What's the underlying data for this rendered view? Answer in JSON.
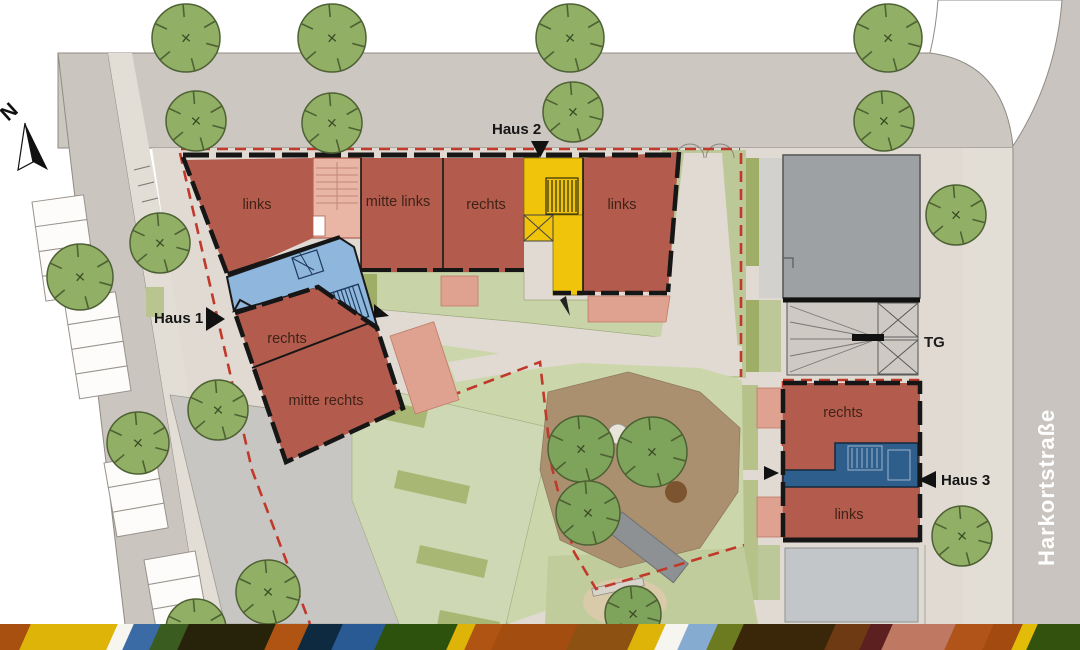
{
  "labels": {
    "north": "N",
    "street": "Harkortstraße",
    "garage": "TG"
  },
  "houses": [
    {
      "name": "Haus 1",
      "tx": 154,
      "ty": 323,
      "triangle": "206,307 206,331 225,319"
    },
    {
      "name": "Haus 2",
      "tx": 492,
      "ty": 134,
      "triangle": "531,141 549,141 540,158"
    },
    {
      "name": "Haus 3",
      "tx": 941,
      "ty": 485,
      "triangle": "936,471 936,488 918,480"
    }
  ],
  "units": [
    {
      "label": "links",
      "x": 257,
      "y": 209
    },
    {
      "label": "mitte links",
      "x": 398,
      "y": 206
    },
    {
      "label": "rechts",
      "x": 486,
      "y": 209
    },
    {
      "label": "links",
      "x": 622,
      "y": 209
    },
    {
      "label": "rechts",
      "x": 287,
      "y": 343
    },
    {
      "label": "mitte rechts",
      "x": 326,
      "y": 405
    },
    {
      "label": "rechts",
      "x": 843,
      "y": 417
    },
    {
      "label": "links",
      "x": 849,
      "y": 519
    }
  ],
  "trees": {
    "street": [
      [
        186,
        38,
        34
      ],
      [
        332,
        38,
        34
      ],
      [
        570,
        38,
        34
      ],
      [
        888,
        38,
        34
      ],
      [
        196,
        121,
        30
      ],
      [
        332,
        123,
        30
      ],
      [
        573,
        112,
        30
      ],
      [
        884,
        121,
        30
      ],
      [
        956,
        215,
        30
      ],
      [
        962,
        536,
        30
      ],
      [
        80,
        277,
        33
      ],
      [
        160,
        243,
        30
      ],
      [
        138,
        443,
        31
      ],
      [
        218,
        410,
        30
      ],
      [
        196,
        629,
        30
      ],
      [
        268,
        592,
        32
      ]
    ],
    "courtyard": [
      [
        581,
        449,
        33
      ],
      [
        652,
        452,
        35
      ],
      [
        588,
        513,
        32
      ],
      [
        633,
        614,
        28
      ]
    ]
  },
  "stripes": [
    {
      "x": 0,
      "w": 25,
      "c": "#a8500f"
    },
    {
      "x": 25,
      "w": 87,
      "c": "#dfb408"
    },
    {
      "x": 112,
      "w": 16,
      "c": "#f7f5f0"
    },
    {
      "x": 128,
      "w": 27,
      "c": "#3a6ba5"
    },
    {
      "x": 155,
      "w": 28,
      "c": "#3b5c20"
    },
    {
      "x": 183,
      "w": 87,
      "c": "#27220a"
    },
    {
      "x": 270,
      "w": 33,
      "c": "#b05413"
    },
    {
      "x": 303,
      "w": 34,
      "c": "#0e2a40"
    },
    {
      "x": 337,
      "w": 43,
      "c": "#2a5a94"
    },
    {
      "x": 380,
      "w": 72,
      "c": "#2c520e"
    },
    {
      "x": 452,
      "w": 18,
      "c": "#dfb408"
    },
    {
      "x": 470,
      "w": 27,
      "c": "#b05413"
    },
    {
      "x": 497,
      "w": 75,
      "c": "#a34d10"
    },
    {
      "x": 572,
      "w": 61,
      "c": "#8d5212"
    },
    {
      "x": 633,
      "w": 27,
      "c": "#dfb408"
    },
    {
      "x": 660,
      "w": 23,
      "c": "#f7f5f0"
    },
    {
      "x": 683,
      "w": 29,
      "c": "#85abd0"
    },
    {
      "x": 712,
      "w": 26,
      "c": "#6c7a20"
    },
    {
      "x": 738,
      "w": 92,
      "c": "#3a2608"
    },
    {
      "x": 830,
      "w": 35,
      "c": "#6e3a14"
    },
    {
      "x": 865,
      "w": 22,
      "c": "#5c2020"
    },
    {
      "x": 887,
      "w": 63,
      "c": "#bf7862"
    },
    {
      "x": 950,
      "w": 38,
      "c": "#b0541a"
    },
    {
      "x": 988,
      "w": 29,
      "c": "#a34a10"
    },
    {
      "x": 1017,
      "w": 15,
      "c": "#e2bc08"
    },
    {
      "x": 1032,
      "w": 48,
      "c": "#32520e"
    }
  ],
  "colors": {
    "building": "#b35b4d",
    "terrace": "#dfa190",
    "stair-salmon": "#e9b5a5",
    "stair-yellow": "#f0c40a",
    "stair-blue": "#8fb6dc",
    "stair-darkblue": "#2e5e8c",
    "existing-gray": "#9da1a3",
    "street": "#cdc7c2",
    "sidewalk": "#e2ddd5",
    "ground": "#e0dad2",
    "plaza": "#c7c6c2",
    "lawn": "#c9d3a8",
    "lawn2": "#bcc897",
    "hedge": "#9fae66",
    "play-brown": "#ab9070",
    "tree": "#92b065",
    "tree-dark": "#7ea35a",
    "boundary-red": "#c0392b",
    "wall-black": "#161616"
  }
}
